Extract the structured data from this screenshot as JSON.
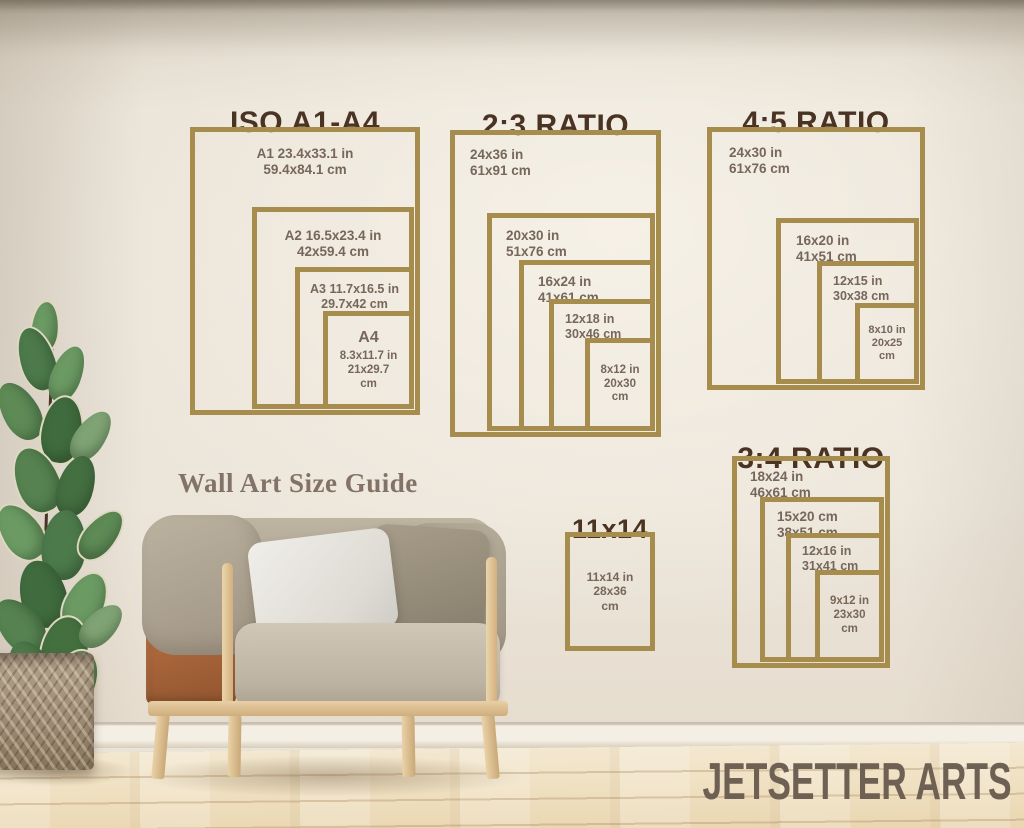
{
  "page": {
    "heading": "Wall Art Size Guide",
    "brand": "JETSETTER ARTS"
  },
  "colors": {
    "frame_gold": "#a68d4e",
    "title_brown": "#4a3322",
    "label_brown": "#77675a",
    "wall": "#eae3d8",
    "floor_wood": "#eddcba"
  },
  "groups": [
    {
      "id": "iso-a1-a4",
      "title": "ISO A1-A4",
      "sizes": [
        {
          "label_lines": [
            "A1 23.4x33.1 in",
            "59.4x84.1 cm"
          ]
        },
        {
          "label_lines": [
            "A2 16.5x23.4 in",
            "42x59.4 cm"
          ]
        },
        {
          "label_lines": [
            "A3 11.7x16.5 in",
            "29.7x42 cm"
          ]
        },
        {
          "name": "A4",
          "label_lines": [
            "8.3x11.7 in",
            "21x29.7",
            "cm"
          ]
        }
      ]
    },
    {
      "id": "ratio-2-3",
      "title": "2:3 RATIO",
      "sizes": [
        {
          "label_lines": [
            "24x36 in",
            "61x91 cm"
          ]
        },
        {
          "label_lines": [
            "20x30 in",
            "51x76 cm"
          ]
        },
        {
          "label_lines": [
            "16x24 in",
            "41x61 cm"
          ]
        },
        {
          "label_lines": [
            "12x18 in",
            "30x46 cm"
          ]
        },
        {
          "label_lines": [
            "8x12 in",
            "20x30",
            "cm"
          ]
        }
      ]
    },
    {
      "id": "ratio-4-5",
      "title": "4:5 RATIO",
      "sizes": [
        {
          "label_lines": [
            "24x30 in",
            "61x76 cm"
          ]
        },
        {
          "label_lines": [
            "16x20 in",
            "41x51 cm"
          ]
        },
        {
          "label_lines": [
            "12x15 in",
            "30x38 cm"
          ]
        },
        {
          "label_lines": [
            "8x10 in",
            "20x25",
            "cm"
          ]
        }
      ]
    },
    {
      "id": "ratio-3-4",
      "title": "3:4 RATIO",
      "sizes": [
        {
          "label_lines": [
            "18x24 in",
            "46x61 cm"
          ]
        },
        {
          "label_lines": [
            "15x20 cm",
            "38x51 cm"
          ]
        },
        {
          "label_lines": [
            "12x16 in",
            "31x41 cm"
          ]
        },
        {
          "label_lines": [
            "9x12 in",
            "23x30",
            "cm"
          ]
        }
      ]
    },
    {
      "id": "size-11x14",
      "title": "11x14",
      "sizes": [
        {
          "label_lines": [
            "11x14 in",
            "28x36",
            "cm"
          ]
        }
      ]
    }
  ]
}
